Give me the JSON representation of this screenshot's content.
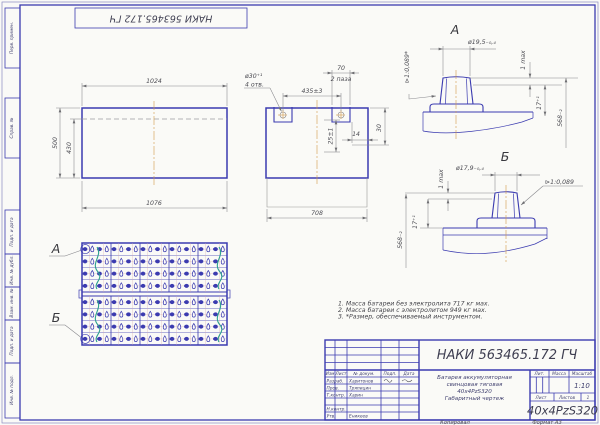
{
  "stamp_top": {
    "code": "НАКИ 563465.172 ГЧ"
  },
  "margin_labels": [
    "Перв. примен.",
    "Справ. №",
    "Подп. и дата",
    "Инв. № дубл.",
    "Взам. инв. №",
    "Подп. и дата",
    "Инв. № подл."
  ],
  "front_view": {
    "dim_top": "1024",
    "dim_bottom": "1076",
    "dim_height": "500",
    "dim_inner": "430"
  },
  "side_view": {
    "hole_dia": "ø30⁺¹",
    "hole_qty": "4 отв.",
    "dim_holes": "435±3",
    "dim_slot": "70",
    "slot_qty": "2 паза",
    "dim_depth": "25±1",
    "dim_step": "30",
    "dim_edge": "14",
    "dim_bottom": "708",
    "taper": "⊳1:0,089*"
  },
  "detail_a": {
    "label": "А",
    "dia": "ø19,5₋₀,₄",
    "gap": "1 max",
    "dim_post": "17⁺¹",
    "dim_height": "568₋₂"
  },
  "detail_b": {
    "label": "Б",
    "dia": "ø17,9₋₀,₄",
    "gap": "1 max",
    "dim_post": "17⁺¹",
    "dim_height": "568₋₂",
    "taper": "⊳1:0,089"
  },
  "top_view": {
    "callout_a": "А",
    "callout_b": "Б",
    "grid": {
      "halves": 2,
      "rows_per_half": 4,
      "cols": 10
    }
  },
  "notes": [
    "1. Масса батареи без электролита 717 кг мах.",
    "2. Масса батареи с электролитом 949 кг мах.",
    "3. *Размер, обеспечиваемый инструментом."
  ],
  "title_block": {
    "doc_code": "НАКИ 563465.172 ГЧ",
    "product_lines": [
      "Батарея аккумуляторная",
      "свинцовая тяговая",
      "40х4PzS320",
      "Габаритный чертеж"
    ],
    "cols": {
      "izm": "Изм",
      "list": "Лист",
      "doc": "№ докум.",
      "sign": "Подп.",
      "date": "Дата"
    },
    "rows": [
      {
        "role": "Разраб.",
        "name": "Харитонов"
      },
      {
        "role": "Пров.",
        "name": "Тряпицин"
      },
      {
        "role": "Т.контр.",
        "name": "Харин"
      },
      {
        "role": "",
        "name": ""
      },
      {
        "role": "Н.контр.",
        "name": ""
      },
      {
        "role": "Утв.",
        "name": "Еникеев"
      }
    ],
    "lit_label": "Лит.",
    "mass_label": "Масса",
    "scale_label": "Масштаб",
    "scale_value": "1:10",
    "sheet_label": "Лист",
    "sheets_label": "Листов",
    "sheets_value": "1",
    "model": "40x4PzS320",
    "copied": "Копировал",
    "format": "Формат  А3"
  },
  "colors": {
    "line_blue": "#3b3bb0",
    "dim_gray": "#85858a",
    "centerline_orange": "#d49a4a",
    "connector_green": "#2da08e"
  }
}
